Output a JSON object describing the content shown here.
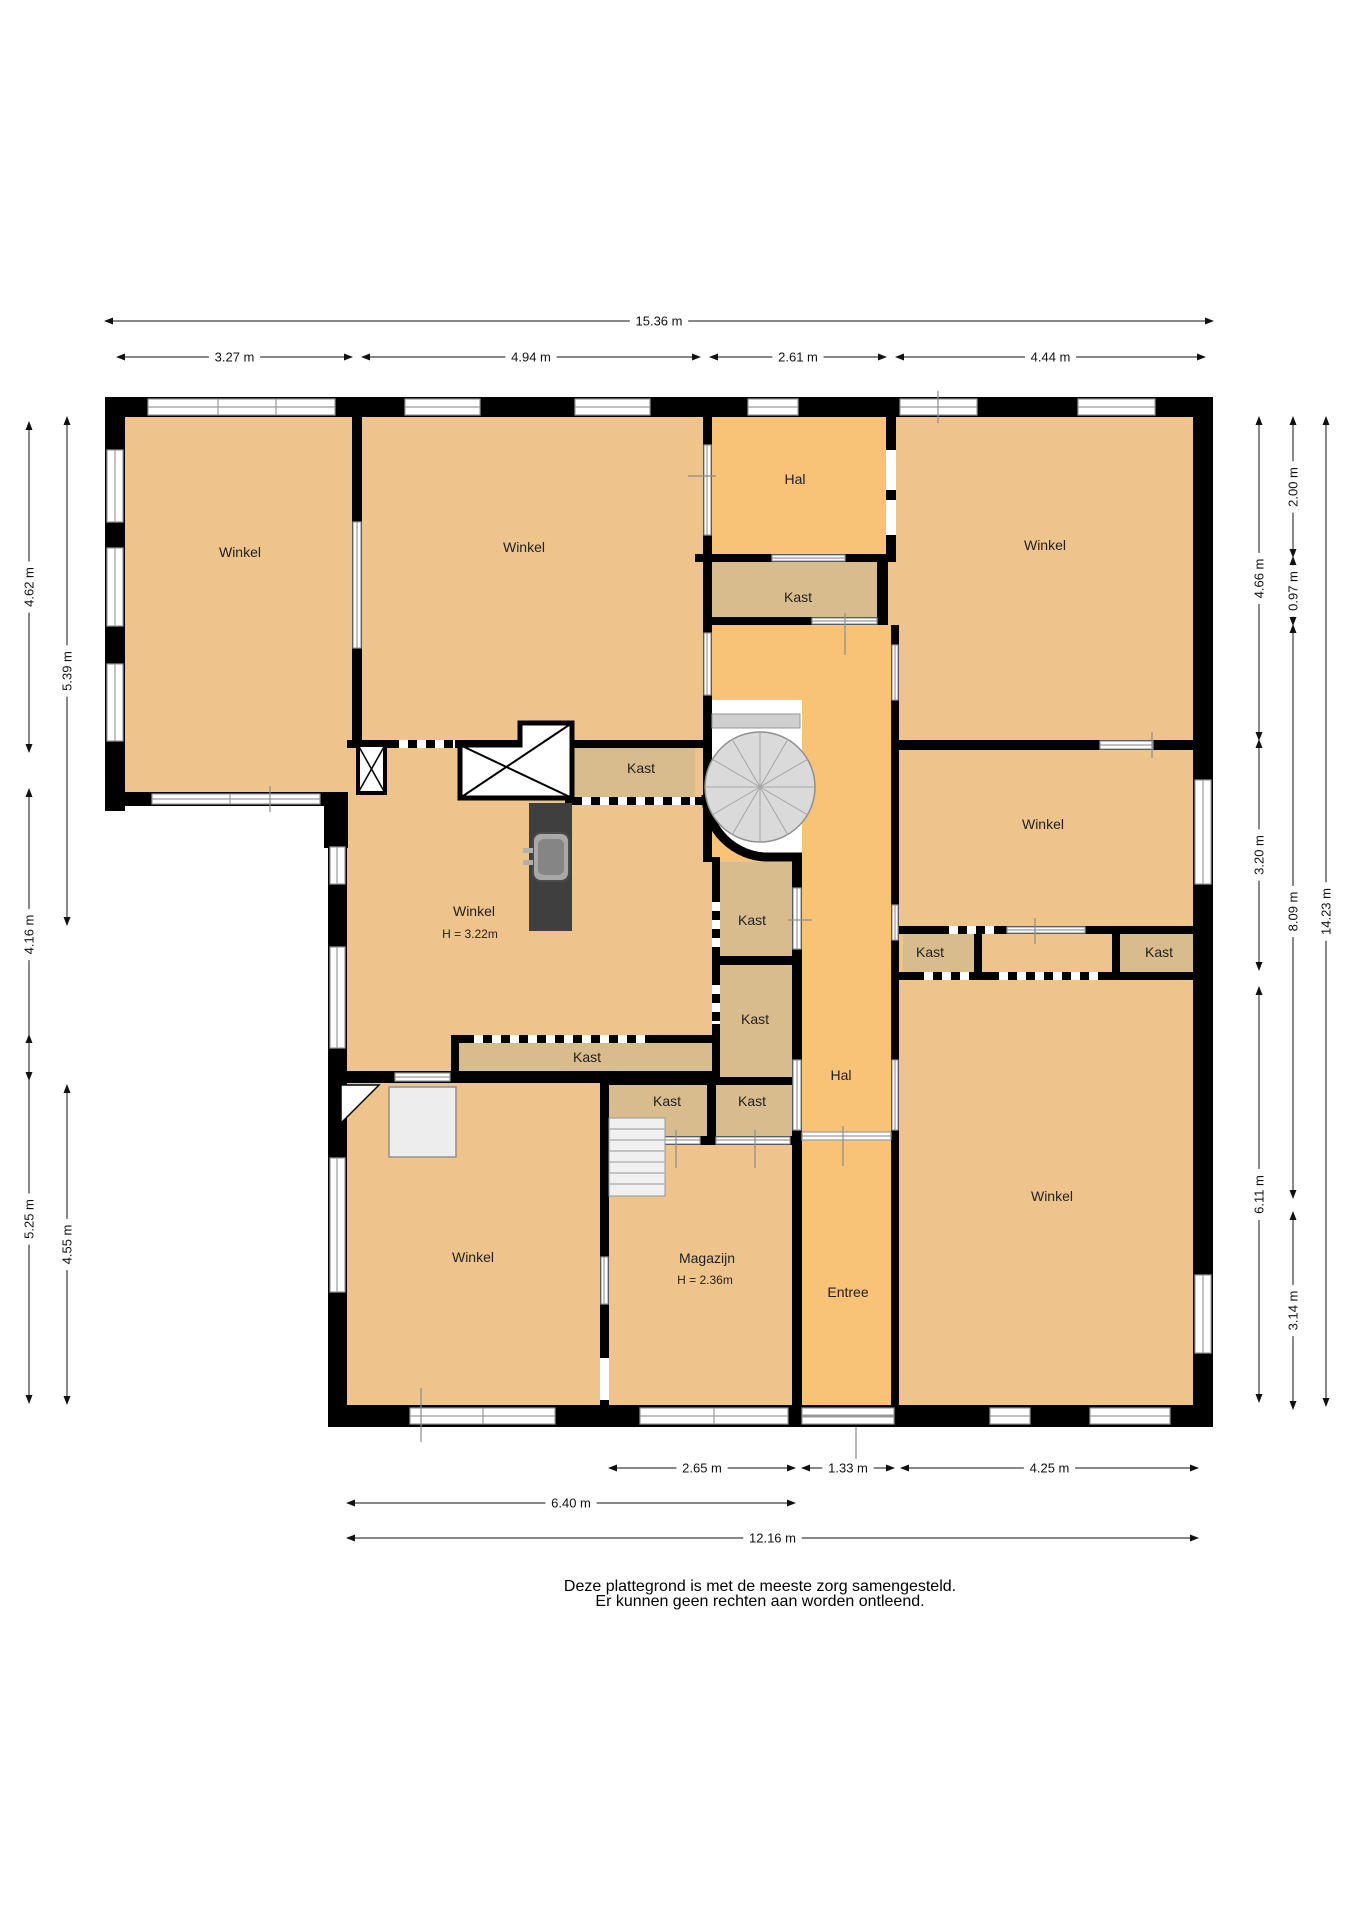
{
  "title": "Floor plan (begane grond) - winkelpand",
  "colors": {
    "winkel_fill": "#eec48c",
    "hal_fill": "#f8c377",
    "kast_fill": "#d9bc8e",
    "wall": "#000000",
    "window_line": "#9a9a9a",
    "counter": "#3f3f3f",
    "stairs_fill": "#f0f0f0",
    "spiral_fill": "#dadada",
    "furniture_fill": "#ededed"
  },
  "rooms": [
    {
      "id": "winkel-top-left",
      "label": "Winkel",
      "x": 240,
      "y": 557
    },
    {
      "id": "winkel-top-mid",
      "label": "Winkel",
      "x": 524,
      "y": 552
    },
    {
      "id": "hal-top",
      "label": "Hal",
      "x": 795,
      "y": 484
    },
    {
      "id": "winkel-top-right",
      "label": "Winkel",
      "x": 1045,
      "y": 550
    },
    {
      "id": "kast-under-hal",
      "label": "Kast",
      "x": 798,
      "y": 602
    },
    {
      "id": "kast-mid-left",
      "label": "Kast",
      "x": 641,
      "y": 773
    },
    {
      "id": "winkel-mid-right",
      "label": "Winkel",
      "x": 1043,
      "y": 829
    },
    {
      "id": "winkel-mid",
      "label": "Winkel",
      "x": 474,
      "y": 916,
      "sub": {
        "label": "H = 3.22m",
        "x": 470,
        "y": 938
      }
    },
    {
      "id": "kast-center-1",
      "label": "Kast",
      "x": 752,
      "y": 925
    },
    {
      "id": "kast-center-2",
      "label": "Kast",
      "x": 755,
      "y": 1024
    },
    {
      "id": "kast-strip",
      "label": "Kast",
      "x": 587,
      "y": 1062
    },
    {
      "id": "kast-right-a",
      "label": "Kast",
      "x": 930,
      "y": 957
    },
    {
      "id": "kast-right-b",
      "label": "Kast",
      "x": 1159,
      "y": 957
    },
    {
      "id": "kast-pair-left",
      "label": "Kast",
      "x": 667,
      "y": 1106
    },
    {
      "id": "kast-pair-right",
      "label": "Kast",
      "x": 752,
      "y": 1106
    },
    {
      "id": "hal-mid",
      "label": "Hal",
      "x": 841,
      "y": 1080
    },
    {
      "id": "winkel-bottom-left",
      "label": "Winkel",
      "x": 473,
      "y": 1262
    },
    {
      "id": "magazijn",
      "label": "Magazijn",
      "x": 707,
      "y": 1263,
      "sub": {
        "label": "H = 2.36m",
        "x": 705,
        "y": 1284
      }
    },
    {
      "id": "entree",
      "label": "Entree",
      "x": 848,
      "y": 1297
    },
    {
      "id": "winkel-bottom-right",
      "label": "Winkel",
      "x": 1052,
      "y": 1201
    }
  ],
  "dimensions": {
    "horizontal": [
      {
        "label": "15.36 m",
        "x1": 105,
        "x2": 1213,
        "y": 321
      },
      {
        "label": "3.27 m",
        "x1": 117,
        "x2": 352,
        "y": 357
      },
      {
        "label": "4.94 m",
        "x1": 362,
        "x2": 700,
        "y": 357
      },
      {
        "label": "2.61 m",
        "x1": 710,
        "x2": 886,
        "y": 357
      },
      {
        "label": "4.44 m",
        "x1": 896,
        "x2": 1205,
        "y": 357
      },
      {
        "label": "2.65 m",
        "x1": 609,
        "x2": 795,
        "y": 1468
      },
      {
        "label": "1.33 m",
        "x1": 802,
        "x2": 894,
        "y": 1468
      },
      {
        "label": "4.25 m",
        "x1": 901,
        "x2": 1198,
        "y": 1468
      },
      {
        "label": "6.40 m",
        "x1": 347,
        "x2": 795,
        "y": 1503
      },
      {
        "label": "12.16 m",
        "x1": 347,
        "x2": 1198,
        "y": 1538
      }
    ],
    "vertical": [
      {
        "label": "4.62 m",
        "x": 29,
        "y1": 422,
        "y2": 752
      },
      {
        "label": "5.39 m",
        "x": 67,
        "y1": 417,
        "y2": 925
      },
      {
        "label": "4.16 m",
        "x": 29,
        "y1": 789,
        "y2": 1080
      },
      {
        "label": "5.25 m",
        "x": 29,
        "y1": 1035,
        "y2": 1403
      },
      {
        "label": "4.55 m",
        "x": 67,
        "y1": 1085,
        "y2": 1404
      },
      {
        "label": "4.66 m",
        "x": 1259,
        "y1": 417,
        "y2": 740
      },
      {
        "label": "3.20 m",
        "x": 1259,
        "y1": 740,
        "y2": 970
      },
      {
        "label": "6.11 m",
        "x": 1259,
        "y1": 987,
        "y2": 1402
      },
      {
        "label": "2.00 m",
        "x": 1293,
        "y1": 417,
        "y2": 557
      },
      {
        "label": "0.97 m",
        "x": 1293,
        "y1": 557,
        "y2": 625
      },
      {
        "label": "8.09 m",
        "x": 1293,
        "y1": 625,
        "y2": 1198
      },
      {
        "label": "3.14 m",
        "x": 1293,
        "y1": 1212,
        "y2": 1409
      },
      {
        "label": "14.23 m",
        "x": 1326,
        "y1": 417,
        "y2": 1406
      }
    ]
  },
  "footer": {
    "line1": "Deze plattegrond is met de meeste zorg samengesteld.",
    "line2": "Er kunnen geen rechten aan worden ontleend."
  }
}
